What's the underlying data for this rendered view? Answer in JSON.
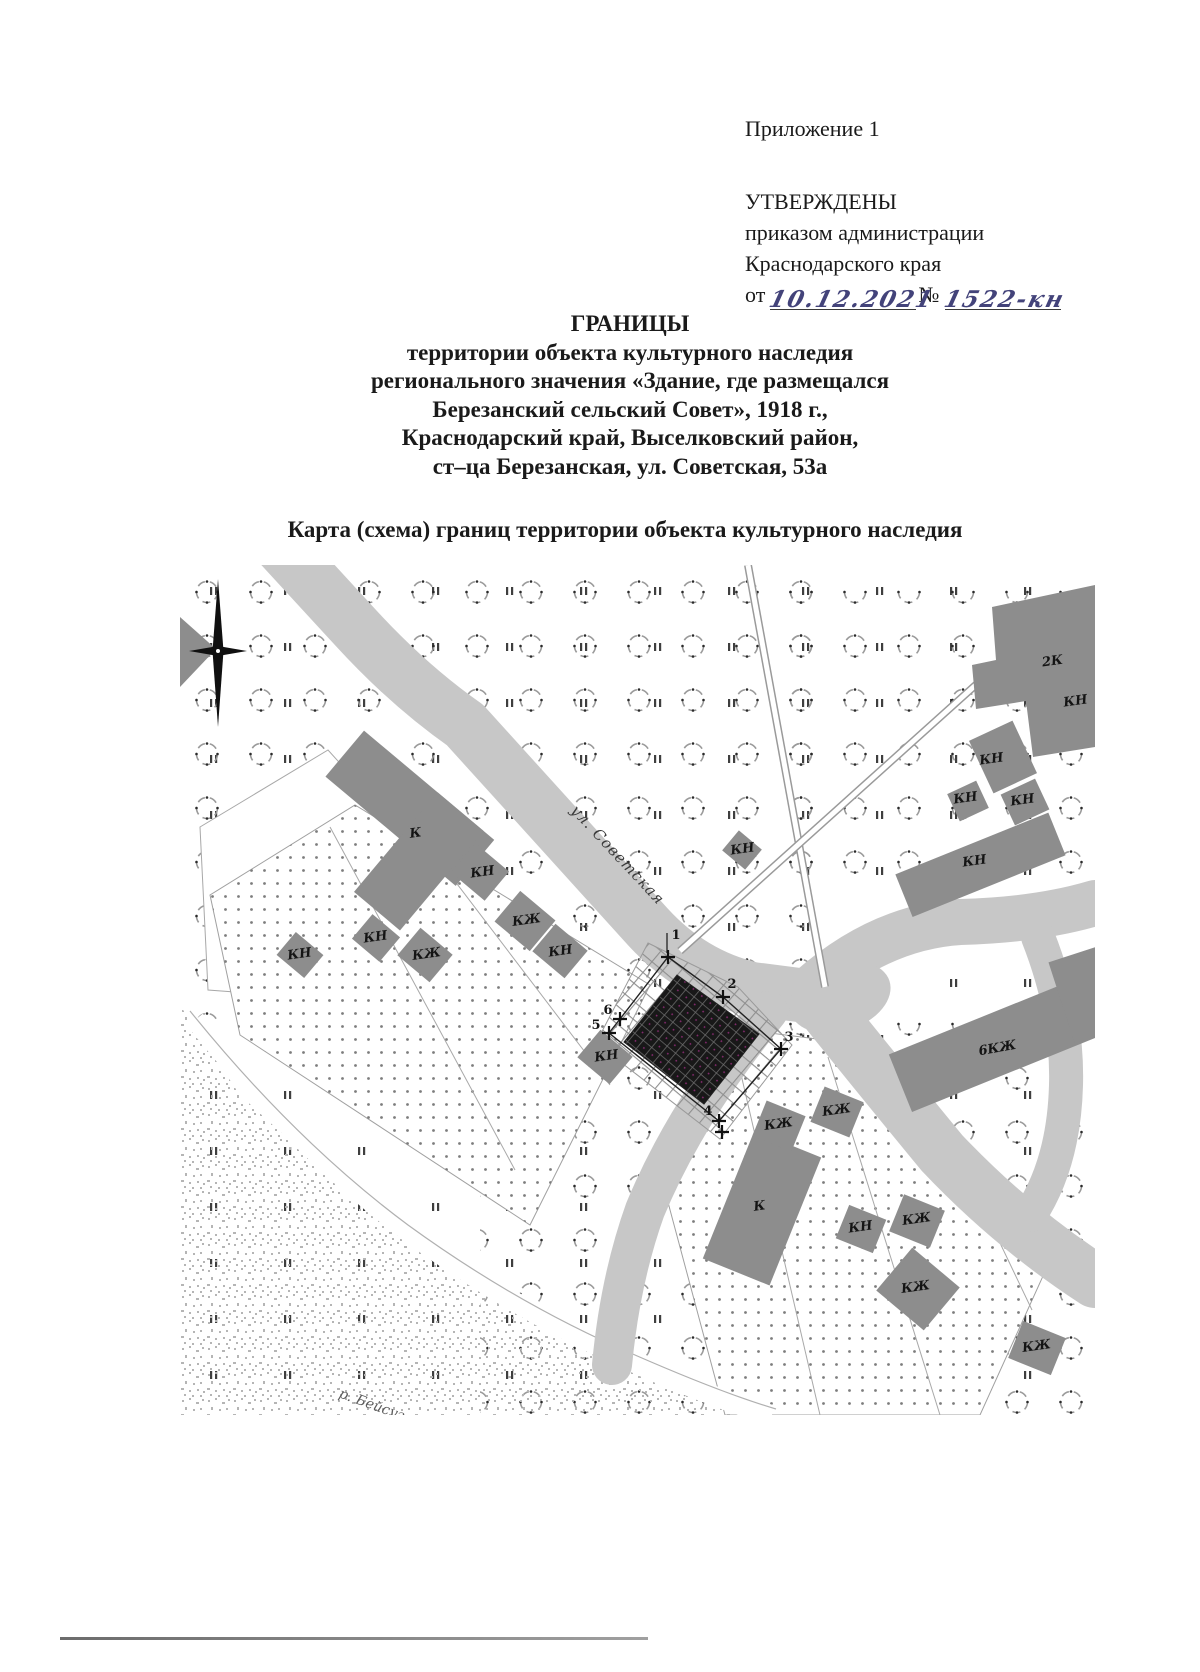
{
  "doc": {
    "appendix": "Приложение 1",
    "approved": "УТВЕРЖДЕНЫ",
    "approved_by_1": "приказом администрации",
    "approved_by_2": "Краснодарского края",
    "from_label": "от",
    "date_value": "10.12.2021",
    "no_label": "№",
    "no_value": "1522-кн",
    "title_lines": [
      "ГРАНИЦЫ",
      "территории объекта культурного наследия",
      "регионального значения «Здание, где размещался",
      "Березанский сельский Совет», 1918 г.,",
      "Краснодарский край, Выселковский район,",
      "ст–ца Березанская, ул. Советская, 53а"
    ],
    "map_caption": "Карта (схема) границ территории объекта культурного наследия"
  },
  "map": {
    "street_label": "ул. Советская",
    "river_label": "р. Бейсуг",
    "colors": {
      "road": "#c7c7c7",
      "building": "#8d8d8d",
      "object": "#181818",
      "river_speckle": "#b5b5b5",
      "hand_ink": "#43437a"
    },
    "building_labels": [
      {
        "t": "К",
        "x": 236,
        "y": 272,
        "r": -8
      },
      {
        "t": "КН",
        "x": 303,
        "y": 311,
        "r": -8
      },
      {
        "t": "КЖ",
        "x": 347,
        "y": 359,
        "r": -8
      },
      {
        "t": "КН",
        "x": 196,
        "y": 376,
        "r": -8
      },
      {
        "t": "КЖ",
        "x": 247,
        "y": 393,
        "r": -8
      },
      {
        "t": "КН",
        "x": 381,
        "y": 390,
        "r": -8
      },
      {
        "t": "КН",
        "x": 120,
        "y": 393,
        "r": -8
      },
      {
        "t": "КН",
        "x": 427,
        "y": 495,
        "r": -8
      },
      {
        "t": "КН",
        "x": 563,
        "y": 288,
        "r": -8
      },
      {
        "t": "2К",
        "x": 873,
        "y": 100,
        "r": -8
      },
      {
        "t": "КН",
        "x": 896,
        "y": 140,
        "r": -8
      },
      {
        "t": "КН",
        "x": 812,
        "y": 198,
        "r": -8
      },
      {
        "t": "КН",
        "x": 786,
        "y": 237,
        "r": -8
      },
      {
        "t": "КН",
        "x": 843,
        "y": 239,
        "r": -8
      },
      {
        "t": "КН",
        "x": 795,
        "y": 300,
        "r": -8
      },
      {
        "t": "6КЖ",
        "x": 818,
        "y": 487,
        "r": -10
      },
      {
        "t": "К",
        "x": 580,
        "y": 645,
        "r": -8
      },
      {
        "t": "КЖ",
        "x": 599,
        "y": 563,
        "r": -8
      },
      {
        "t": "КЖ",
        "x": 657,
        "y": 549,
        "r": -8
      },
      {
        "t": "КН",
        "x": 681,
        "y": 666,
        "r": -8
      },
      {
        "t": "КЖ",
        "x": 737,
        "y": 658,
        "r": -8
      },
      {
        "t": "КЖ",
        "x": 736,
        "y": 726,
        "r": -8
      },
      {
        "t": "КЖ",
        "x": 857,
        "y": 785,
        "r": -8
      }
    ],
    "boundary_points": [
      {
        "n": "1",
        "x": 488,
        "y": 392,
        "lx": 496,
        "ly": 374
      },
      {
        "n": "2",
        "x": 543,
        "y": 432,
        "lx": 552,
        "ly": 423
      },
      {
        "n": "3",
        "x": 601,
        "y": 484,
        "lx": 609,
        "ly": 476
      },
      {
        "n": "4",
        "x": 539,
        "y": 556,
        "lx": 528,
        "ly": 550
      },
      {
        "n": "5",
        "x": 429,
        "y": 468,
        "lx": 416,
        "ly": 464
      },
      {
        "n": "6",
        "x": 440,
        "y": 454,
        "lx": 428,
        "ly": 449
      }
    ]
  }
}
